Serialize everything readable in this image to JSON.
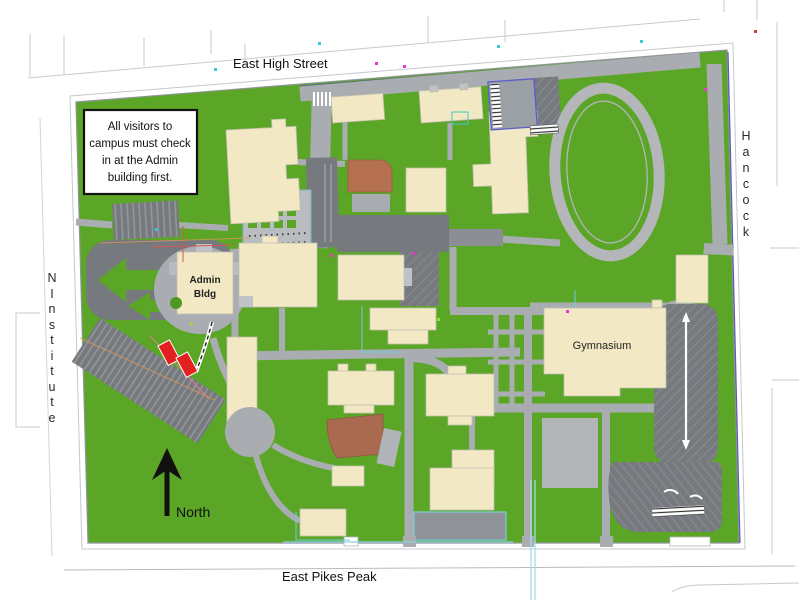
{
  "streets": {
    "top": "East High Street",
    "bottom": "East Pikes Peak",
    "right": {
      "name": "Hancock",
      "letters": [
        "H",
        "a",
        "n",
        "c",
        "o",
        "c",
        "k"
      ]
    },
    "left": {
      "name": "N Institute",
      "letters": [
        "N",
        "I",
        "n",
        "s",
        "t",
        "i",
        "t",
        "u",
        "t",
        "e"
      ]
    }
  },
  "notice": {
    "lines": [
      "All visitors to",
      "campus must check",
      "in at the Admin",
      "building first."
    ]
  },
  "buildings": {
    "admin": {
      "lines": [
        "Admin",
        "Bldg"
      ]
    },
    "gymnasium": {
      "label": "Gymnasium"
    }
  },
  "compass": {
    "label": "North"
  },
  "colors": {
    "grass": "#5BA627",
    "road": "#A9ADB1",
    "parking": "#76797D",
    "building": "#F2E8C4",
    "building_brown": "#B5714F",
    "accent_red": "#E32020",
    "track": "#B4B6BA",
    "cyan_line": "#8AD4E4",
    "boundary_blue": "#5B5BB8",
    "notice_border": "#111111"
  }
}
